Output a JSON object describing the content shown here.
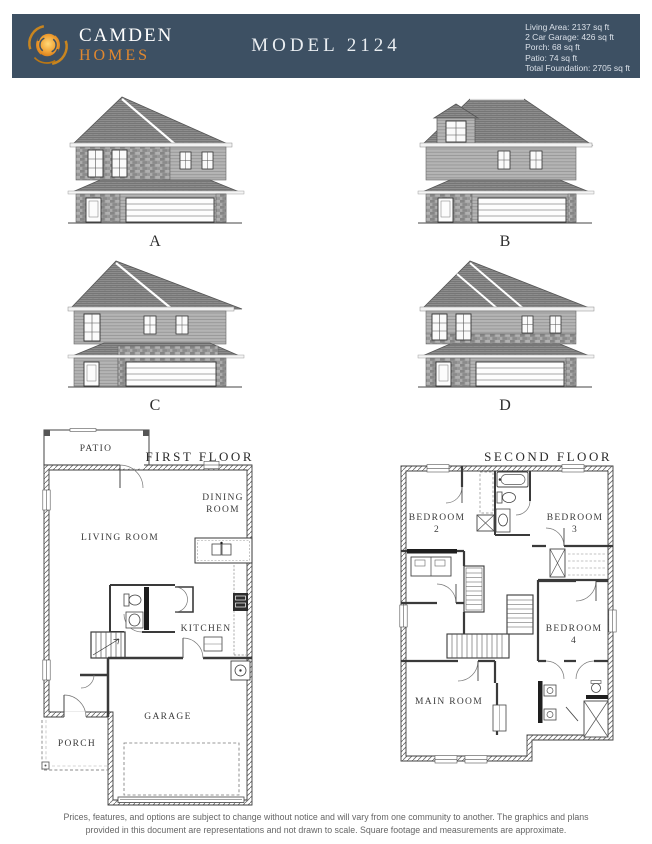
{
  "header": {
    "brand": {
      "name": "CAMDEN",
      "sub": "HOMES"
    },
    "title": "MODEL 2124",
    "stats": {
      "living_area": "Living Area: 2137 sq ft",
      "garage": "2 Car Garage: 426 sq ft",
      "porch": "Porch: 68 sq ft",
      "patio": "Patio: 74 sq ft",
      "total_foundation": "Total Foundation: 2705 sq ft"
    },
    "colors": {
      "bar_bg": "#3d5063",
      "accent_orange": "#e0872f",
      "title_text": "#e9edf1"
    }
  },
  "elevations": {
    "a": "A",
    "b": "B",
    "c": "C",
    "d": "D"
  },
  "first_floor": {
    "title": "FIRST FLOOR",
    "patio": "PATIO",
    "dining_line1": "DINING",
    "dining_line2": "ROOM",
    "living_room": "LIVING ROOM",
    "kitchen": "KITCHEN",
    "garage": "GARAGE",
    "porch": "PORCH"
  },
  "second_floor": {
    "title": "SECOND FLOOR",
    "bedroom2_line1": "BEDROOM",
    "bedroom2_line2": "2",
    "bedroom3_line1": "BEDROOM",
    "bedroom3_line2": "3",
    "bedroom4_line1": "BEDROOM",
    "bedroom4_line2": "4",
    "main_room": "MAIN ROOM"
  },
  "footer": {
    "line1": "Prices, features, and options are subject to change without notice and will vary from one community to another. The graphics and plans",
    "line2": "provided in this document are representations and not drawn to scale. Square footage and measurements are approximate."
  }
}
